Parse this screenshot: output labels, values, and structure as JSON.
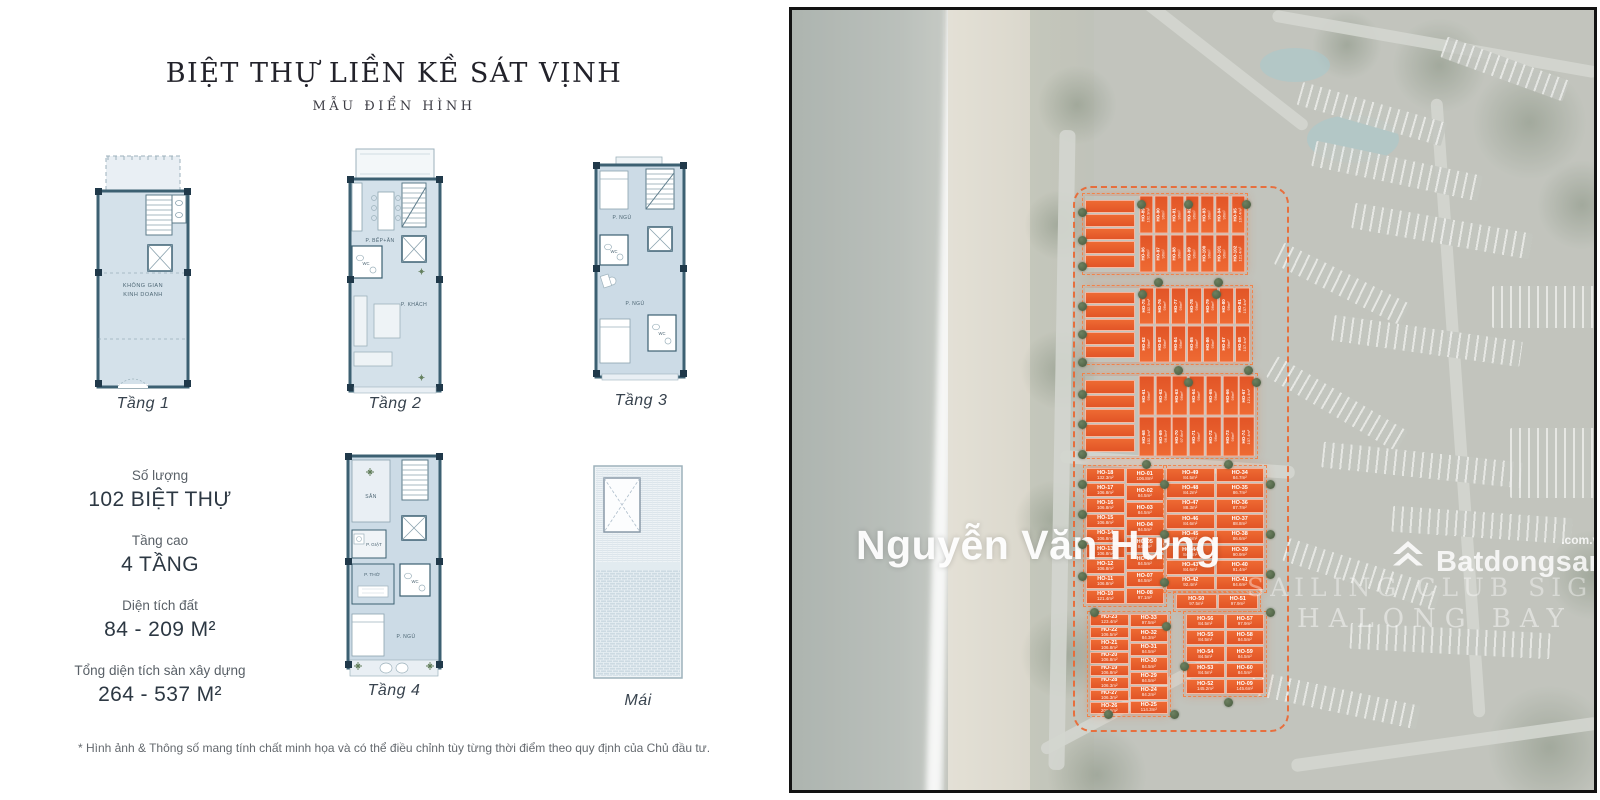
{
  "left_panel": {
    "title": "BIỆT THỰ LIỀN KỀ SÁT VỊNH",
    "subtitle": "MẪU ĐIỂN HÌNH",
    "plans": [
      {
        "id": "tang-1",
        "label": "Tầng 1",
        "rooms": [
          "KHÔNG GIAN",
          "KINH DOANH"
        ]
      },
      {
        "id": "tang-2",
        "label": "Tầng 2",
        "rooms": [
          "P. BẾP+ĂN",
          "WC",
          "P. KHÁCH"
        ]
      },
      {
        "id": "tang-3",
        "label": "Tầng 3",
        "rooms": [
          "P. NGỦ",
          "WC",
          "P. NGỦ",
          "WC"
        ]
      },
      {
        "id": "tang-4",
        "label": "Tầng 4",
        "rooms": [
          "SÂN",
          "P. GIẶT",
          "P. THỜ",
          "WC",
          "P. NGỦ"
        ]
      },
      {
        "id": "mai",
        "label": "Mái",
        "rooms": []
      }
    ],
    "stats": [
      {
        "label": "Số lượng",
        "value": "102 BIỆT THỰ"
      },
      {
        "label": "Tầng cao",
        "value": "4 TẦNG"
      },
      {
        "label": "Diện tích đất",
        "value": "84 - 209 M²"
      },
      {
        "label": "Tổng diện tích sàn xây dựng",
        "value": "264 - 537 M²"
      }
    ],
    "footnote": "* Hình ảnh & Thông số mang tính chất minh họa và có thể điều chỉnh tùy từng thời điểm theo quy định của Chủ đầu tư."
  },
  "map": {
    "watermark": "Nguyễn Văn Hưng",
    "brand": {
      "name": "Batdongsan",
      "suffix": ".com.vn"
    },
    "project": {
      "line1": "SAILING CLUB SIGNATURE",
      "line2": "HALONG BAY"
    },
    "colors": {
      "lot_orange_top": "#ee6a33",
      "lot_orange_bottom": "#e25527",
      "boundary": "#eb6630"
    },
    "clusters": [
      {
        "id": "block-a",
        "type": "rotated",
        "x": 293,
        "y": 186,
        "w": 160,
        "h": 76,
        "strips": 5,
        "rows": [
          [
            {
              "id": "HO-89",
              "area": "102.9m²"
            },
            {
              "id": "HO-90",
              "area": "96m²"
            },
            {
              "id": "HO-91",
              "area": "96m²"
            },
            {
              "id": "HO-92",
              "area": "96m²"
            },
            {
              "id": "HO-93",
              "area": "96m²"
            },
            {
              "id": "HO-94",
              "area": "96m²"
            },
            {
              "id": "HO-95",
              "area": "107.4m²"
            }
          ],
          [
            {
              "id": "HO-96",
              "area": "96m²"
            },
            {
              "id": "HO-97",
              "area": "96m²"
            },
            {
              "id": "HO-98",
              "area": "96m²"
            },
            {
              "id": "HO-99",
              "area": "96m²"
            },
            {
              "id": "HO-100",
              "area": "96m²"
            },
            {
              "id": "HO-101",
              "area": "96m²"
            },
            {
              "id": "HO-102",
              "area": "121.4m²"
            }
          ]
        ]
      },
      {
        "id": "block-b",
        "type": "rotated",
        "x": 293,
        "y": 278,
        "w": 165,
        "h": 74,
        "strips": 5,
        "rows": [
          [
            {
              "id": "HO-75",
              "area": "102.9m²"
            },
            {
              "id": "HO-76",
              "area": "96m²"
            },
            {
              "id": "HO-77",
              "area": "96m²"
            },
            {
              "id": "HO-78",
              "area": "96m²"
            },
            {
              "id": "HO-79",
              "area": "96m²"
            },
            {
              "id": "HO-80",
              "area": "96m²"
            },
            {
              "id": "HO-81",
              "area": "107.4m²"
            }
          ],
          [
            {
              "id": "HO-82",
              "area": "96m²"
            },
            {
              "id": "HO-83",
              "area": "96m²"
            },
            {
              "id": "HO-84",
              "area": "96m²"
            },
            {
              "id": "HO-85",
              "area": "96m²"
            },
            {
              "id": "HO-86",
              "area": "96m²"
            },
            {
              "id": "HO-87",
              "area": "96m²"
            },
            {
              "id": "HO-88",
              "area": "107.4m²"
            }
          ]
        ]
      },
      {
        "id": "block-c",
        "type": "rotated",
        "x": 293,
        "y": 366,
        "w": 170,
        "h": 80,
        "strips": 5,
        "rows": [
          [
            {
              "id": "HO-61",
              "area": "96m²"
            },
            {
              "id": "HO-62",
              "area": "96m²"
            },
            {
              "id": "HO-63",
              "area": "96m²"
            },
            {
              "id": "HO-64",
              "area": "96m²"
            },
            {
              "id": "HO-65",
              "area": "96m²"
            },
            {
              "id": "HO-66",
              "area": "96m²"
            },
            {
              "id": "HO-67",
              "area": "121.4m²"
            }
          ],
          [
            {
              "id": "HO-68",
              "area": "102.1m²"
            },
            {
              "id": "HO-69",
              "area": "96.5m²"
            },
            {
              "id": "HO-70",
              "area": "97.6m²"
            },
            {
              "id": "HO-71",
              "area": "96m²"
            },
            {
              "id": "HO-72",
              "area": "96m²"
            },
            {
              "id": "HO-73",
              "area": "96m²"
            },
            {
              "id": "HO-74",
              "area": "107.4m²"
            }
          ]
        ]
      },
      {
        "id": "block-d",
        "type": "grid",
        "x": 294,
        "y": 458,
        "w": 78,
        "h": 136,
        "columns": [
          [
            {
              "id": "HO-18",
              "area": "132.3m²"
            },
            {
              "id": "HO-17",
              "area": "106.8m²"
            },
            {
              "id": "HO-16",
              "area": "106.8m²"
            },
            {
              "id": "HO-15",
              "area": "106.8m²"
            },
            {
              "id": "HO-14",
              "area": "106.8m²"
            },
            {
              "id": "HO-13",
              "area": "106.8m²"
            },
            {
              "id": "HO-12",
              "area": "106.8m²"
            },
            {
              "id": "HO-11",
              "area": "106.8m²"
            },
            {
              "id": "HO-10",
              "area": "121.4m²"
            }
          ],
          [
            {
              "id": "HO-01",
              "area": "106.8m²"
            },
            {
              "id": "HO-02",
              "area": "84.5m²"
            },
            {
              "id": "HO-03",
              "area": "84.5m²"
            },
            {
              "id": "HO-04",
              "area": "84.5m²"
            },
            {
              "id": "HO-05",
              "area": "84.5m²"
            },
            {
              "id": "HO-06",
              "area": "84.5m²"
            },
            {
              "id": "HO-07",
              "area": "84.5m²"
            },
            {
              "id": "HO-08",
              "area": "97.1m²"
            }
          ]
        ]
      },
      {
        "id": "block-e",
        "type": "grid",
        "x": 374,
        "y": 458,
        "w": 98,
        "h": 122,
        "columns": [
          [
            {
              "id": "HO-49",
              "area": "84.5m²"
            },
            {
              "id": "HO-48",
              "area": "84.2m²"
            },
            {
              "id": "HO-47",
              "area": "88.3m²"
            },
            {
              "id": "HO-46",
              "area": "84.6m²"
            },
            {
              "id": "HO-45",
              "area": "84.6m²"
            },
            {
              "id": "HO-44",
              "area": "84.6m²"
            },
            {
              "id": "HO-43",
              "area": "84.6m²"
            },
            {
              "id": "HO-42",
              "area": "92.4m²"
            }
          ],
          [
            {
              "id": "HO-34",
              "area": "84.7m²"
            },
            {
              "id": "HO-35",
              "area": "86.7m²"
            },
            {
              "id": "HO-36",
              "area": "87.7m²"
            },
            {
              "id": "HO-37",
              "area": "88.8m²"
            },
            {
              "id": "HO-38",
              "area": "86.6m²"
            },
            {
              "id": "HO-39",
              "area": "90.9m²"
            },
            {
              "id": "HO-40",
              "area": "91.4m²"
            },
            {
              "id": "HO-41",
              "area": "84.6m²"
            }
          ]
        ]
      },
      {
        "id": "block-e2",
        "type": "grid",
        "x": 384,
        "y": 584,
        "w": 82,
        "h": 15,
        "columns": [
          [
            {
              "id": "HO-50",
              "area": "97.5m²"
            }
          ],
          [
            {
              "id": "HO-51",
              "area": "97.9m²"
            }
          ]
        ]
      },
      {
        "id": "block-f",
        "type": "grid",
        "x": 298,
        "y": 604,
        "w": 78,
        "h": 100,
        "columns": [
          [
            {
              "id": "HO-23",
              "area": "123.4m²"
            },
            {
              "id": "HO-22",
              "area": "106.5m²"
            },
            {
              "id": "HO-21",
              "area": "106.8m²"
            },
            {
              "id": "HO-20",
              "area": "106.8m²"
            },
            {
              "id": "HO-19",
              "area": "106.8m²"
            },
            {
              "id": "HO-28",
              "area": "106.3m²"
            },
            {
              "id": "HO-27",
              "area": "106.3m²"
            },
            {
              "id": "HO-26",
              "area": "209.6m²"
            }
          ],
          [
            {
              "id": "HO-33",
              "area": "97.5m²"
            },
            {
              "id": "HO-32",
              "area": "84.3m²"
            },
            {
              "id": "HO-31",
              "area": "84.5m²"
            },
            {
              "id": "HO-30",
              "area": "84.5m²"
            },
            {
              "id": "HO-29",
              "area": "84.5m²"
            },
            {
              "id": "HO-24",
              "area": "84.2m²"
            },
            {
              "id": "HO-25",
              "area": "114.3m²"
            }
          ]
        ]
      },
      {
        "id": "block-g",
        "type": "grid",
        "x": 394,
        "y": 604,
        "w": 78,
        "h": 80,
        "columns": [
          [
            {
              "id": "HO-56",
              "area": "84.5m²"
            },
            {
              "id": "HO-55",
              "area": "84.5m²"
            },
            {
              "id": "HO-54",
              "area": "84.5m²"
            },
            {
              "id": "HO-53",
              "area": "84.5m²"
            },
            {
              "id": "HO-52",
              "area": "145.2m²"
            }
          ],
          [
            {
              "id": "HO-57",
              "area": "97.9m²"
            },
            {
              "id": "HO-58",
              "area": "84.5m²"
            },
            {
              "id": "HO-59",
              "area": "84.5m²"
            },
            {
              "id": "HO-60",
              "area": "84.5m²"
            },
            {
              "id": "HO-09",
              "area": "145.6m²"
            }
          ]
        ]
      }
    ]
  }
}
